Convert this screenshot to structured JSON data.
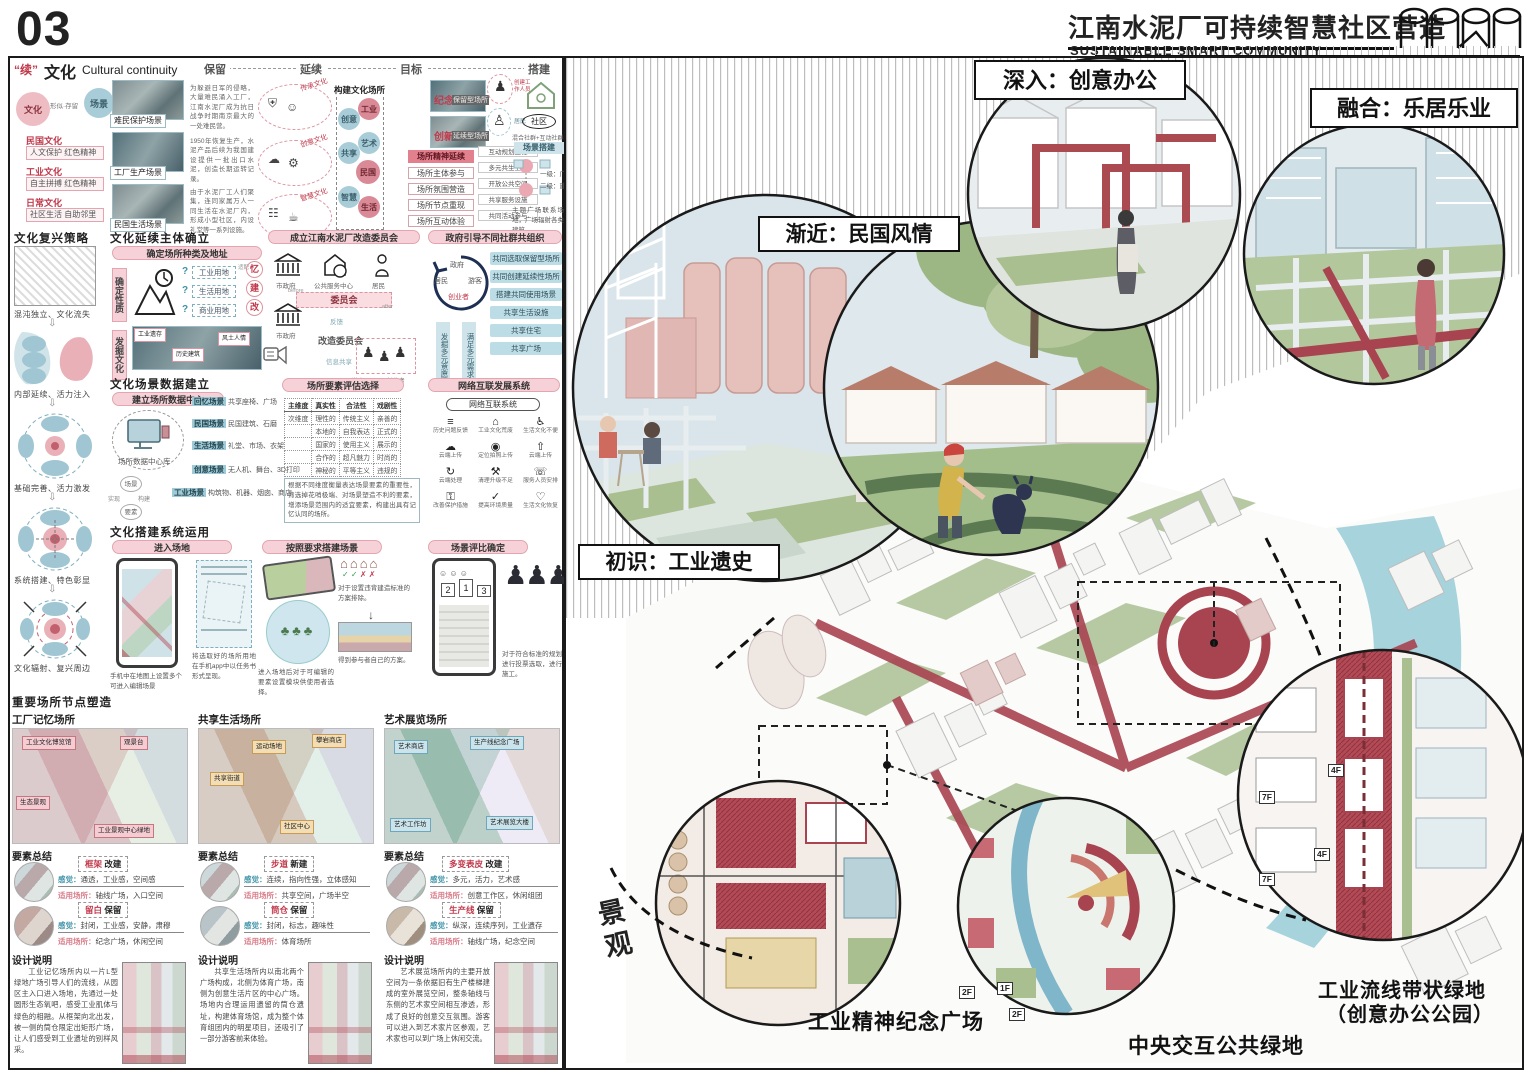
{
  "page": {
    "number": "03"
  },
  "header": {
    "title_cn": "江南水泥厂可持续智慧社区营造",
    "title_en": "SUSTAINABLE SMART COMMUNITY"
  },
  "s1": {
    "tag": "“续”",
    "title": "文化",
    "subtitle": "Cultural continuity",
    "stages": [
      "保留",
      "延续",
      "目标",
      "搭建"
    ],
    "culture": "文化",
    "scene": "场景",
    "link": "形似·存留",
    "types": [
      {
        "t": "民国文化",
        "d": "人文保护 红色精神"
      },
      {
        "t": "工业文化",
        "d": "自主拼搏 红色精神"
      },
      {
        "t": "日常文化",
        "d": "社区生活 自助邻里"
      }
    ],
    "photos": [
      {
        "label": "难民保护场景",
        "note": "为躲避日军的侵略，大量难民涌入工厂，江南水泥厂成为抗日战争时期南京最大的一处难民营。"
      },
      {
        "label": "工厂生产场景",
        "note": "1950年恢复生产，水泥产品后续为我国建设提供一批出口水泥，创造长期运转记录。"
      },
      {
        "label": "民国生活场景",
        "note": "由于水泥厂工人们聚集，连同家属万人一同生活在水泥厂内，形成小型社区，内设礼堂等一系列设施。"
      }
    ],
    "ellipse_labels": [
      "传承文化",
      "创意文化",
      "智慧文化"
    ],
    "build_title": "构建文化场所",
    "place_circles": [
      "工业",
      "创意",
      "艺术",
      "共享",
      "民国",
      "智慧",
      "生活"
    ],
    "goal": {
      "memory": "纪念",
      "memory_d": "保留型场所",
      "innovate": "创新",
      "innovate_d": "延续型场所",
      "spirit": "场所精神延续",
      "chain": [
        "场所主体参与",
        "场所氛围营造",
        "场所节点重现",
        "场所互动体验"
      ],
      "side": [
        "互动规划工程",
        "多元共生空间",
        "开放公共空间",
        "共享服务设施",
        "共同活动参与"
      ]
    },
    "staff": "创建工作人员",
    "resident": "居民",
    "community": "社区",
    "community_caption": "混合社群+互动社群",
    "scene_build": {
      "title": "场景搭建",
      "l1": "一级：广场",
      "l2": "二级：建筑",
      "caption": "主题广场联系场地，广场辐射各类建筑。"
    }
  },
  "s2": {
    "revive": {
      "title": "文化复兴策略",
      "steps": [
        "混沌独立、文化流失",
        "内部延续、活力注入",
        "基础完善、活力激发",
        "系统搭建、特色彰显",
        "文化辐射、复兴周边"
      ]
    },
    "subject": {
      "title": "文化延续主体确立",
      "pill": "确定场所种类及地址",
      "v1": "确定性质",
      "v2": "发掘文化",
      "match": "适配",
      "lands": [
        {
          "q": "?",
          "name": "工业用地",
          "r": "忆"
        },
        {
          "q": "?",
          "name": "生活用地",
          "r": "建"
        },
        {
          "q": "?",
          "name": "商业用地",
          "r": "改"
        }
      ],
      "dig": [
        "工业遗存",
        "历史建筑",
        "风土人情"
      ]
    },
    "committee": {
      "pill": "成立江南水泥厂改造委员会",
      "gov": "市政府",
      "center": "公共服务中心",
      "resident": "居民",
      "before": "before",
      "after": "after",
      "council": "委员会",
      "council2": "改造委员会",
      "feedback": "反馈",
      "share": "信息共享",
      "groups": "游客 · 居民 · 创业者"
    },
    "org": {
      "pill": "政府引导不同社群共组织",
      "circle": [
        "政府",
        "居民",
        "游客",
        "创业者"
      ],
      "left1": "发掘多元意愿",
      "left2": "满足多元需求",
      "boxes": [
        "共同选取保留型场所",
        "共同创建延续性场所",
        "搭建共同使用场景",
        "共享生活设施",
        "共享住宅",
        "共享广场"
      ]
    }
  },
  "s3": {
    "title": "文化场景数据建立",
    "pill": "建立场所数据中心",
    "db": "场所数据中心库",
    "bubbles": [
      "场景",
      "实现",
      "构建",
      "要素"
    ],
    "scenes": [
      {
        "tag": "回忆场景",
        "d": "共享座椅、广场"
      },
      {
        "tag": "民国场景",
        "d": "民国建筑、石磨"
      },
      {
        "tag": "生活场景",
        "d": "礼堂、市场、衣架"
      },
      {
        "tag": "创意场景",
        "d": "无人机、舞台、3D打印"
      },
      {
        "tag": "工业场景",
        "d": "构筑物、机器、烟囱、商店"
      }
    ],
    "eval": {
      "pill": "场所要素评估选择",
      "h": [
        "主维度",
        "真实性",
        "合法性",
        "戏剧性"
      ],
      "sub": "次维度",
      "rows": [
        [
          "理性的",
          "传统主义",
          "亲善的"
        ],
        [
          "本地的",
          "自我表达",
          "正式的"
        ],
        [
          "国家的",
          "使用主义",
          "展示的"
        ],
        [
          "合作的",
          "超凡魅力",
          "时尚的"
        ],
        [
          "神秘的",
          "平等主义",
          "违规的"
        ]
      ],
      "caption": "根据不同维度衡量表达场景要素的重要性，筛选掉花哨极端、对场景塑造不利的要素，增添场景范围内的适宜要素，构建出具有记忆认同的场所。"
    },
    "net": {
      "pill": "网络互联发展系统",
      "box": "网络互联系统",
      "items": [
        "历史问题反馈",
        "工业文化荒废",
        "生活文化不便",
        "云端上传",
        "定位拍照上传",
        "云端上传",
        "云端处理",
        "清理升级不足",
        "服务人员安排",
        "改善保护措施",
        "提高环境质量",
        "生活文化恢复"
      ]
    }
  },
  "s4": {
    "title": "文化搭建系统运用",
    "pills": [
      "进入场地",
      "按照要求搭建场景",
      "场景评比确定"
    ],
    "captions": [
      "手机中在地图上设置多个可进入编辑场景",
      "将选取好的场所用地在手机app中以任务书形式呈现。",
      "进入场地后对于可编辑的要素设置模块供使用者选择。",
      "对于设置违背建造标准的方案排除。",
      "得到参与者自己的方案。",
      "对于符合标准的规划进行投票选取，进行施工。"
    ],
    "rank": [
      "2",
      "1",
      "3"
    ]
  },
  "s5": {
    "summary_label": "要素总结",
    "design_label": "设计说明",
    "title": "重要场所节点塑造",
    "feel_label": "感觉：",
    "use_label": "适用场所：",
    "cols": [
      {
        "title": "工厂记忆场所",
        "labels": [
          "工业文化博览馆",
          "观景台",
          "生态景观",
          "工业景观中心绿地"
        ],
        "rows": [
          {
            "a": "框架",
            "bb": "改建",
            "feel": "通透，工业感，空间感",
            "use": "轴线广场，入口空间"
          },
          {
            "a": "留白",
            "bb": "保留",
            "feel": "封闭，工业感，安静，肃穆",
            "use": "纪念广场，休闲空间"
          }
        ],
        "design": "工业记忆场所内以一片L型绿地广场引导人们的流线，从园区主入口进入场地，先通过一处圆形生态氧吧，感受工业肌体与绿色的相融。从框架向北出发，被一侧的筒仓限定出矩形广场，让人们感受到工业遗址的别样风采。"
      },
      {
        "title": "共享生活场所",
        "labels": [
          "运动场地",
          "攀岩商店",
          "共享街道",
          "社区中心"
        ],
        "rows": [
          {
            "a": "步道",
            "bb": "新建",
            "feel": "连续，指向性强，立体感知",
            "use": "共享空间，广场半空"
          },
          {
            "a": "筒仓",
            "bb": "保留",
            "feel": "封闭，标志，趣味性",
            "use": "体育场所"
          }
        ],
        "design": "共享生活场所内以南北两个广场构成，北侧为体育广场，南侧为创意生活片区的中心广场。场地内合理运用遗留的筒仓遗址，构建体育场馆，成为整个体育组团内的明星项目，还吸引了一部分游客前来体验。"
      },
      {
        "title": "艺术展览场所",
        "labels": [
          "艺术商店",
          "生产线纪念广场",
          "艺术工作坊",
          "艺术展览大楼"
        ],
        "rows": [
          {
            "a": "多变表皮",
            "bb": "改建",
            "feel": "多元，活力，艺术感",
            "use": "创意工作区，休闲组团"
          },
          {
            "a": "生产线",
            "bb": "保留",
            "feel": "纵深，连续序列，工业遗存",
            "use": "轴线广场，纪念空间"
          }
        ],
        "design": "艺术展览场所内的主要开放空间为一条依据旧有生产楼梯建成的室外展览空间，整条轴线与东侧的艺术家空间相互渗透，形成了良好的创意交互氛围。游客可以进入到艺术家片区参观，艺术家也可以到广场上休闲交流。"
      }
    ]
  },
  "right": {
    "callouts": [
      "初识：工业遗史",
      "渐近：民国风情",
      "深入：创意办公",
      "融合：乐居乐业"
    ],
    "landscape": "景观",
    "label_plaza": "工业精神纪念广场",
    "label_green": "中央交互公共绿地",
    "belt1": "工业流线带状绿地",
    "belt2": "（创意办公公园）",
    "floors": [
      "4F",
      "7F",
      "4F",
      "7F",
      "2F",
      "1F",
      "2F"
    ]
  }
}
